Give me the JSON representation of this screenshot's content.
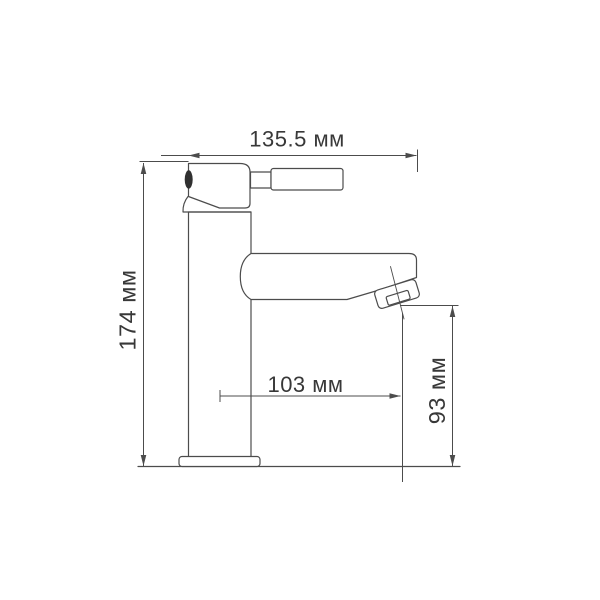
{
  "diagram": {
    "type": "technical-drawing",
    "subject": "basin faucet side view with dimensions",
    "units": "мм",
    "dimensions": [
      {
        "id": "overall-width",
        "label": "135.5 мм"
      },
      {
        "id": "overall-height",
        "label": "174 мм"
      },
      {
        "id": "spout-reach",
        "label": "103 мм"
      },
      {
        "id": "spout-height",
        "label": "93 мм"
      }
    ],
    "colors": {
      "background": "#ffffff",
      "line": "#4c4c4c",
      "text": "#383838",
      "screw_fill": "#303030"
    }
  }
}
